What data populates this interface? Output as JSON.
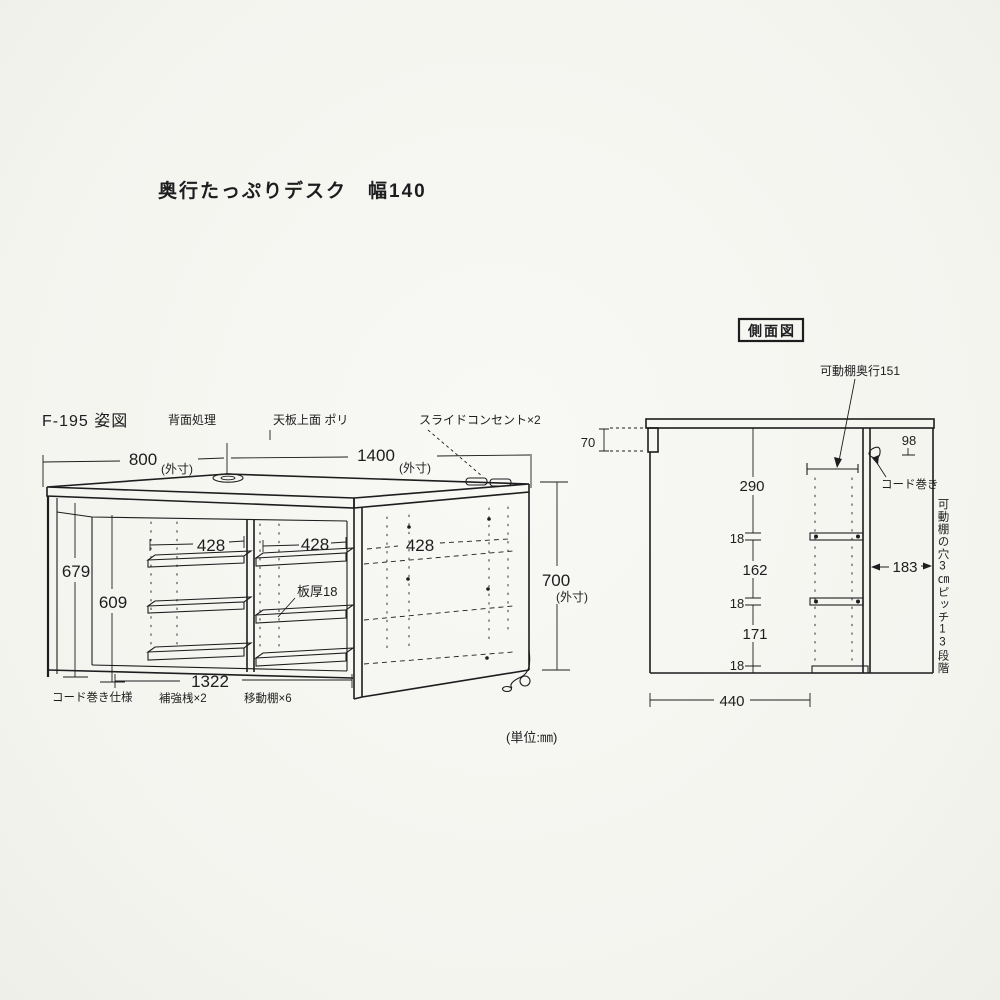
{
  "title": "奥行たっぷりデスク　幅140",
  "unit_note": "(単位:㎜)",
  "front_view": {
    "label": "F-195 姿図",
    "back_treatment": "背面処理",
    "top_surface": "天板上面 ポリ",
    "slide_outlet": "スライドコンセント×2",
    "suffix_outer": "(外寸)",
    "dim_depth": "800",
    "dim_width": "1400",
    "dim_height": "700",
    "dim_inner_left": "679",
    "dim_inner_right": "609",
    "dim_inner_width": "1322",
    "dim_shelf_left": "428",
    "dim_shelf_center": "428",
    "dim_shelf_side": "428",
    "board_thickness": "板厚18",
    "cord_spec": "コード巻き仕様",
    "reinforcement": "補強桟×2",
    "movable_shelves": "移動棚×6"
  },
  "side_view": {
    "label": "側面図",
    "shelf_depth": "可動棚奥行151",
    "cord_winder": "コード巻き",
    "pitch_note": "可動棚の穴3㎝ピッチ13段階",
    "dim_top_front": "70",
    "dim_back_top": "98",
    "dim_290": "290",
    "dim_18_top": "18",
    "dim_162": "162",
    "dim_18_mid": "18",
    "dim_171": "171",
    "dim_18_bottom": "18",
    "dim_183": "183",
    "dim_440": "440"
  },
  "colors": {
    "ink": "#1d1d1f",
    "paper": "#f6f6f2"
  }
}
